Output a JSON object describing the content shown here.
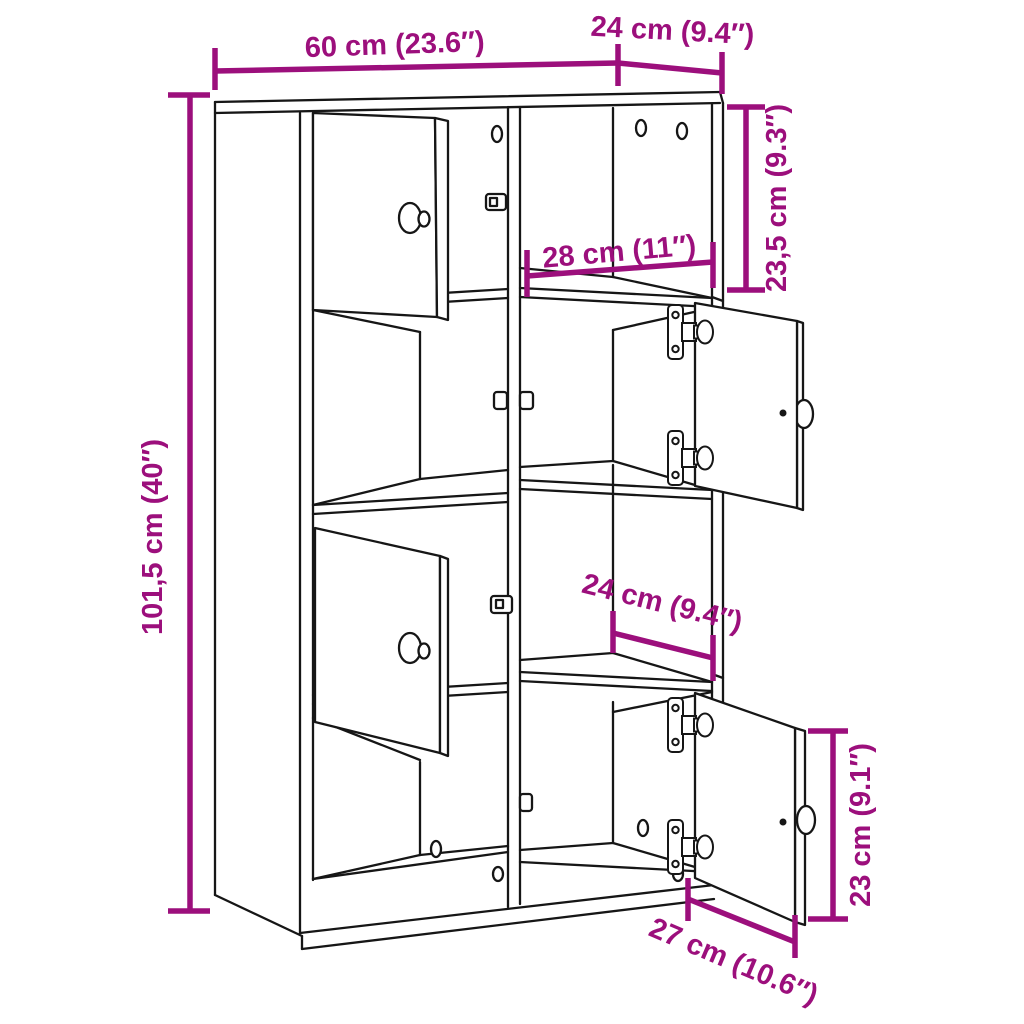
{
  "diagram_type": "furniture-dimension-diagram",
  "product": "bookcase-with-doors",
  "colors": {
    "dimension_annotation": "#9c0f7c",
    "line_art": "#161616",
    "background": "#ffffff"
  },
  "labels": {
    "width": "60 cm (23.6″)",
    "depth": "24 cm (9.4″)",
    "height": "101,5 cm (40″)",
    "top_compartment_height": "23,5 cm (9.3″)",
    "inner_width": "28 cm (11″)",
    "inner_depth": "24 cm (9.4″)",
    "bottom_door_width": "27 cm (10.6″)",
    "bottom_door_height": "23 cm (9.1″)"
  },
  "measurements": [
    {
      "id": "width",
      "cm": 60,
      "inches": 23.6
    },
    {
      "id": "depth",
      "cm": 24,
      "inches": 9.4
    },
    {
      "id": "height",
      "cm": 101.5,
      "inches": 40
    },
    {
      "id": "top_compartment_height",
      "cm": 23.5,
      "inches": 9.3
    },
    {
      "id": "inner_width",
      "cm": 28,
      "inches": 11
    },
    {
      "id": "inner_depth",
      "cm": 24,
      "inches": 9.4
    },
    {
      "id": "bottom_door_width",
      "cm": 27,
      "inches": 10.6
    },
    {
      "id": "bottom_door_height",
      "cm": 23,
      "inches": 9.1
    }
  ]
}
